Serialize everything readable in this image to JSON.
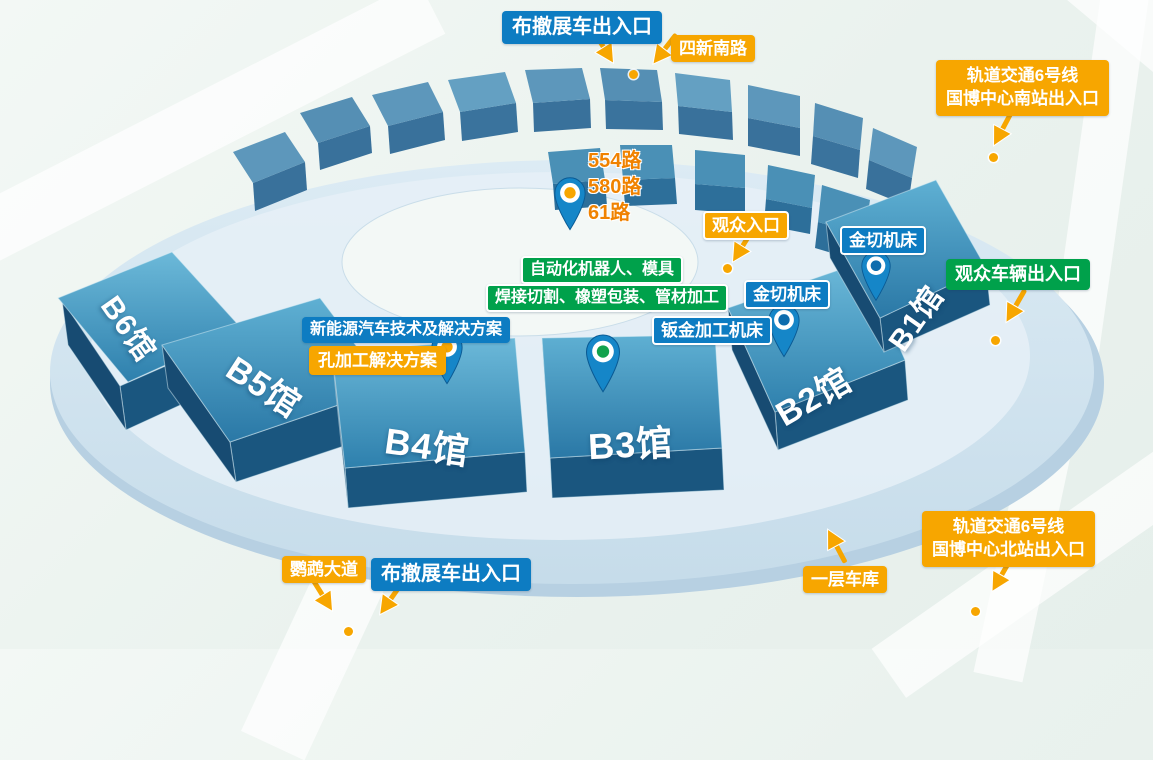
{
  "map": {
    "entrances": {
      "truck_top": "布撤展车出入口",
      "truck_bottom": "布撤展车出入口",
      "visitor_entrance": "观众入口",
      "visitor_vehicle_exit": "观众车辆出入口"
    },
    "roads": {
      "sixin_south": "四新南路",
      "yingwu_avenue": "鹦鹉大道"
    },
    "metro_south": {
      "line1": "轨道交通6号线",
      "line2": "国博中心南站出入口"
    },
    "metro_north": {
      "line1": "轨道交通6号线",
      "line2": "国博中心北站出入口"
    },
    "bus_routes": [
      "554路",
      "580路",
      "61路"
    ],
    "exhibits": {
      "automation": "自动化机器人、模具",
      "welding": "焊接切割、橡塑包装、管材加工",
      "nev": "新能源汽车技术及解决方案",
      "hole_processing": "孔加工解决方案",
      "sheet_metal": "钣金加工机床",
      "metal_cutting_b1": "金切机床",
      "metal_cutting_b2": "金切机床"
    },
    "garage": "一层车库",
    "halls": [
      {
        "name": "B6馆"
      },
      {
        "name": "B5馆"
      },
      {
        "name": "B4馆"
      },
      {
        "name": "B3馆"
      },
      {
        "name": "B2馆"
      },
      {
        "name": "B1馆"
      }
    ]
  },
  "colors": {
    "label_blue": "#0d7cc2",
    "label_orange": "#f7a600",
    "label_green": "#00a14b",
    "bus_text_orange": "#f08200",
    "arrow_orange": "#f7a600",
    "marker_dot_orange": "#f7a600",
    "pin_body_blue": "#1180c4",
    "pin_center_orange": "#f7a600",
    "pin_center_green": "#12a24d",
    "pin_center_blue": "#0e6cad",
    "building_top_blue": "#3489b4",
    "building_side_blue": "#1a567f",
    "platform_blue": "#d3e5f0",
    "background_mint": "#ecf4f0"
  }
}
